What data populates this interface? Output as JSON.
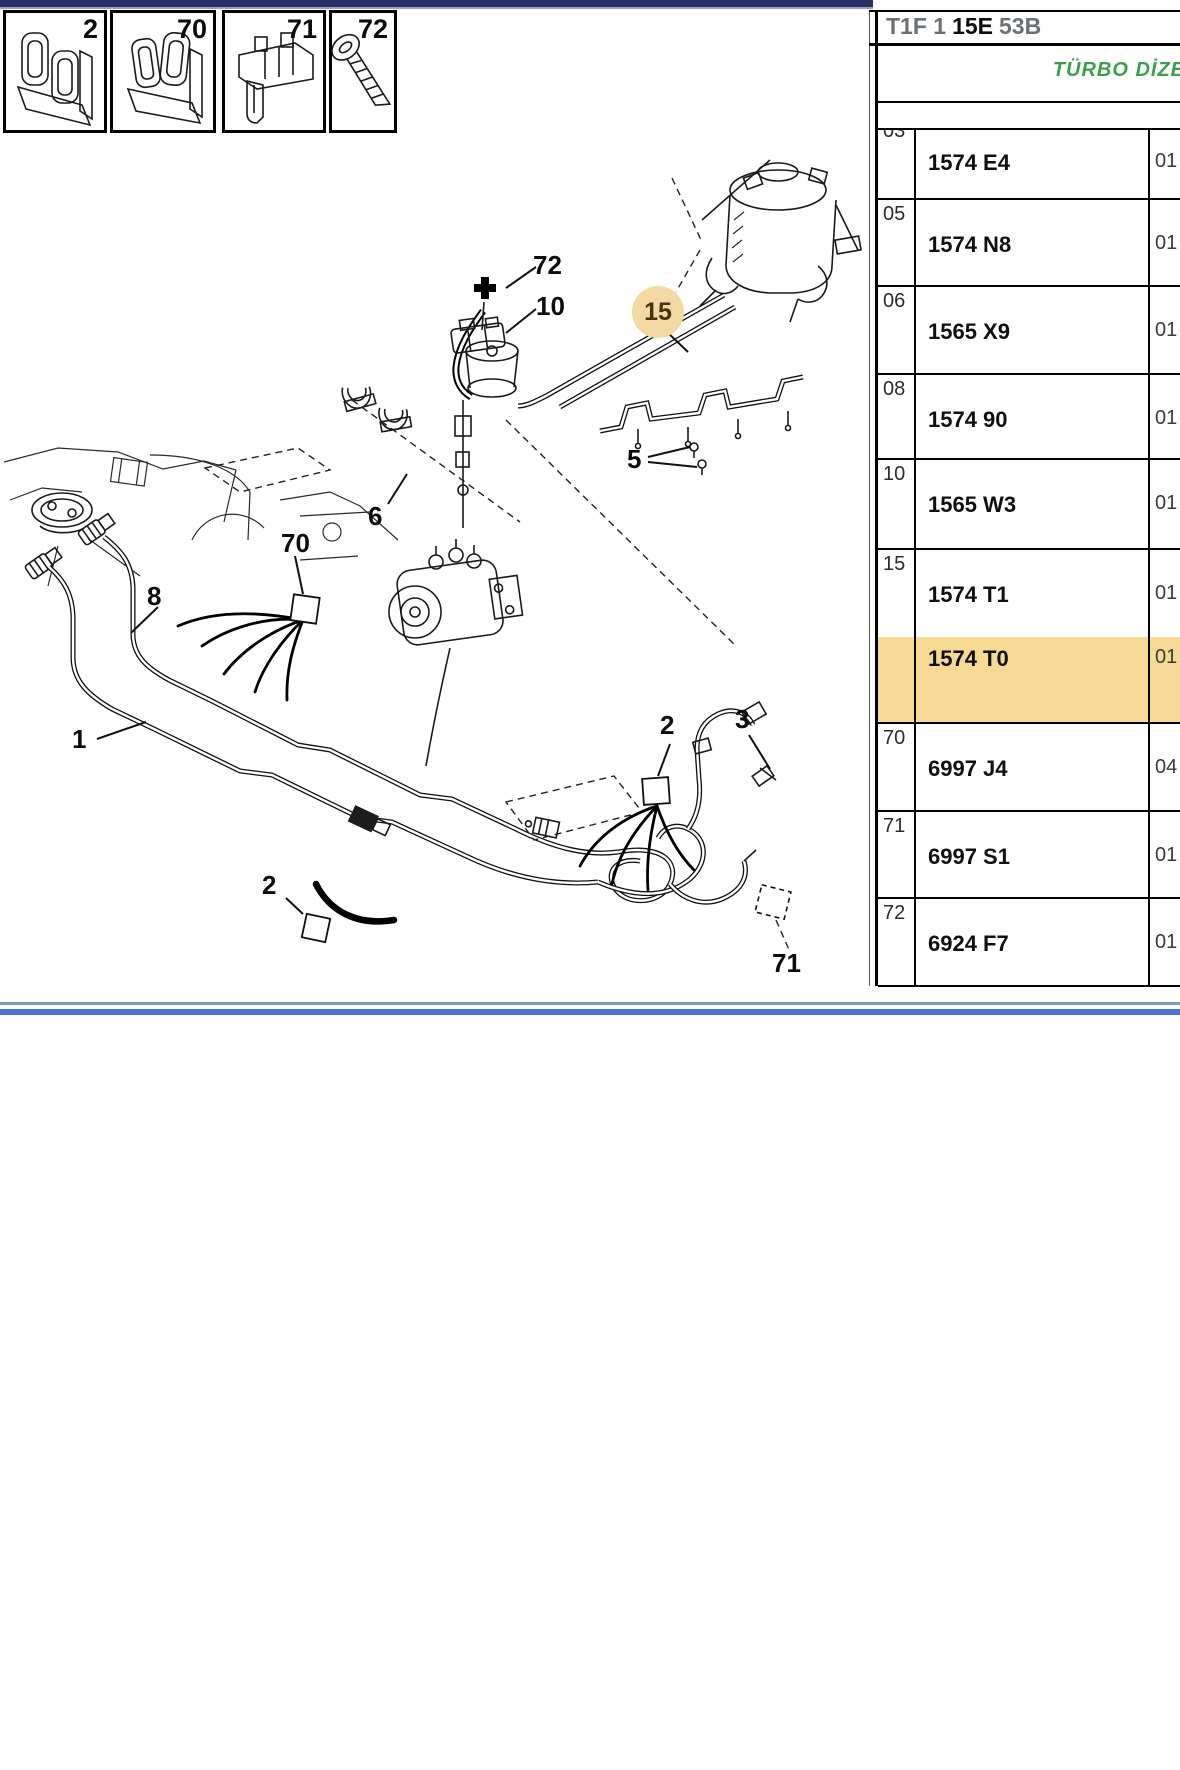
{
  "header": {
    "code_prefix": "T1F 1",
    "code_bold": "15E",
    "code_suffix": "53B",
    "subtitle": "TÜRBO DİZE"
  },
  "legend": {
    "boxes": [
      {
        "label": "2",
        "icon": "pipe-clip"
      },
      {
        "label": "70",
        "icon": "pipe-clip"
      },
      {
        "label": "71",
        "icon": "connector-clip"
      },
      {
        "label": "72",
        "icon": "screw"
      }
    ]
  },
  "diagram": {
    "callouts": {
      "c72": "72",
      "c10": "10",
      "c15": "15",
      "c5": "5",
      "c6": "6",
      "c70": "70",
      "c8": "8",
      "c1": "1",
      "c2_mid": "2",
      "c3": "3",
      "c2_left": "2",
      "c71": "71"
    },
    "highlight": {
      "selected_item": "15",
      "circle_color": "#f3d8a2"
    }
  },
  "parts_table": {
    "highlight_color": "#f6d992",
    "rows": [
      {
        "index": "03",
        "part_number": "1574 E4",
        "quantity": "01",
        "highlighted": false
      },
      {
        "index": "05",
        "part_number": "1574 N8",
        "quantity": "01",
        "highlighted": false
      },
      {
        "index": "06",
        "part_number": "1565 X9",
        "quantity": "01",
        "highlighted": false
      },
      {
        "index": "08",
        "part_number": "1574 90",
        "quantity": "01",
        "highlighted": false
      },
      {
        "index": "10",
        "part_number": "1565 W3",
        "quantity": "01",
        "highlighted": false
      },
      {
        "index": "15",
        "part_number": "1574 T1",
        "quantity": "01",
        "highlighted": false
      },
      {
        "index": "",
        "part_number": "1574 T0",
        "quantity": "01",
        "highlighted": true
      },
      {
        "index": "70",
        "part_number": "6997 J4",
        "quantity": "04",
        "highlighted": false
      },
      {
        "index": "71",
        "part_number": "6997 S1",
        "quantity": "01",
        "highlighted": false
      },
      {
        "index": "72",
        "part_number": "6924 F7",
        "quantity": "01",
        "highlighted": false
      }
    ]
  }
}
